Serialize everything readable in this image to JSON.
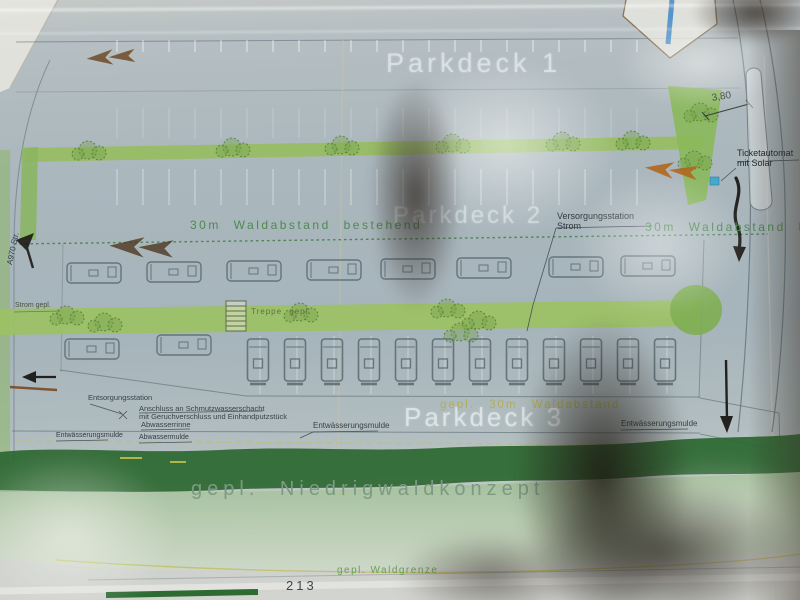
{
  "plan": {
    "decks": {
      "d1": "Parkdeck 1",
      "d2": "Parkdeck 2",
      "d3": "Parkdeck 3"
    },
    "forest": {
      "wald_left": "30m Waldabstand bestehend",
      "wald_right": "30m Waldabstand bestehend",
      "gepl_wald": "gepl. 30m Waldabstand",
      "niedrigwald": "gepl. Niedrigwaldkonzept",
      "waldgrenze": "gepl. Waldgrenze"
    },
    "utilities": {
      "versorgung1": "Versorgungsstation",
      "versorgung2": "Strom",
      "ticket1": "Ticketautomat",
      "ticket2": "mit Solar",
      "treppe": "Treppe gepl.",
      "strom_gepl": "Strom gepl.",
      "entsorgung": "Entsorgungsstation",
      "anschluss1": "Anschluss an Schmutzwasserschacht",
      "anschluss2": "mit Geruchverschluss und Einhandputzstück",
      "abwasserrinne": "Abwasserrinne",
      "mulde_a": "Entwässerungsmulde",
      "mulde_b": "Abwassermulde",
      "mulde_c": "Entwässerungsmulde",
      "mulde_d": "Entwässerungsmulde"
    },
    "dims": {
      "road_width": "3,80",
      "parcel": "213",
      "road_label": "A970 Str."
    }
  },
  "colors": {
    "sheet": "#a9b7bd",
    "hedge_green": "#97bd5e",
    "dark_green_band": "#2d6832",
    "label_green": "#4d8a50",
    "label_yellow": "#b3ad4e",
    "ink": "#39424a",
    "ticket_blue": "#45a8cc",
    "arrow_brown": "#6f4a26",
    "arrow_orange": "#b2661c"
  }
}
